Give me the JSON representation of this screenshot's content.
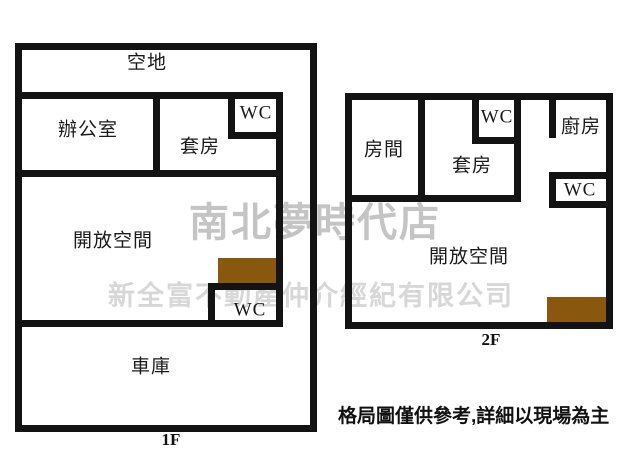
{
  "floorplan_1f": {
    "floor_label": "1F",
    "rooms": {
      "yard": "空地",
      "office": "辦公室",
      "suite": "套房",
      "wc_top": "WC",
      "open_space": "開放空間",
      "wc_bottom": "WC",
      "garage": "車庫"
    }
  },
  "floorplan_2f": {
    "floor_label": "2F",
    "rooms": {
      "room": "房間",
      "suite": "套房",
      "wc_top": "WC",
      "kitchen": "廚房",
      "wc_right": "WC",
      "open_space": "開放空間"
    }
  },
  "watermarks": {
    "store_name": "南北夢時代店",
    "company_name": "新全富不動產仲介經紀有限公司"
  },
  "disclaimer": "格局圖僅供參考,詳細以現場為主",
  "colors": {
    "wall": "#131313",
    "stairs": "#8a570e",
    "watermark_store": "#c4c4c4",
    "watermark_company": "#d7d7d7"
  }
}
